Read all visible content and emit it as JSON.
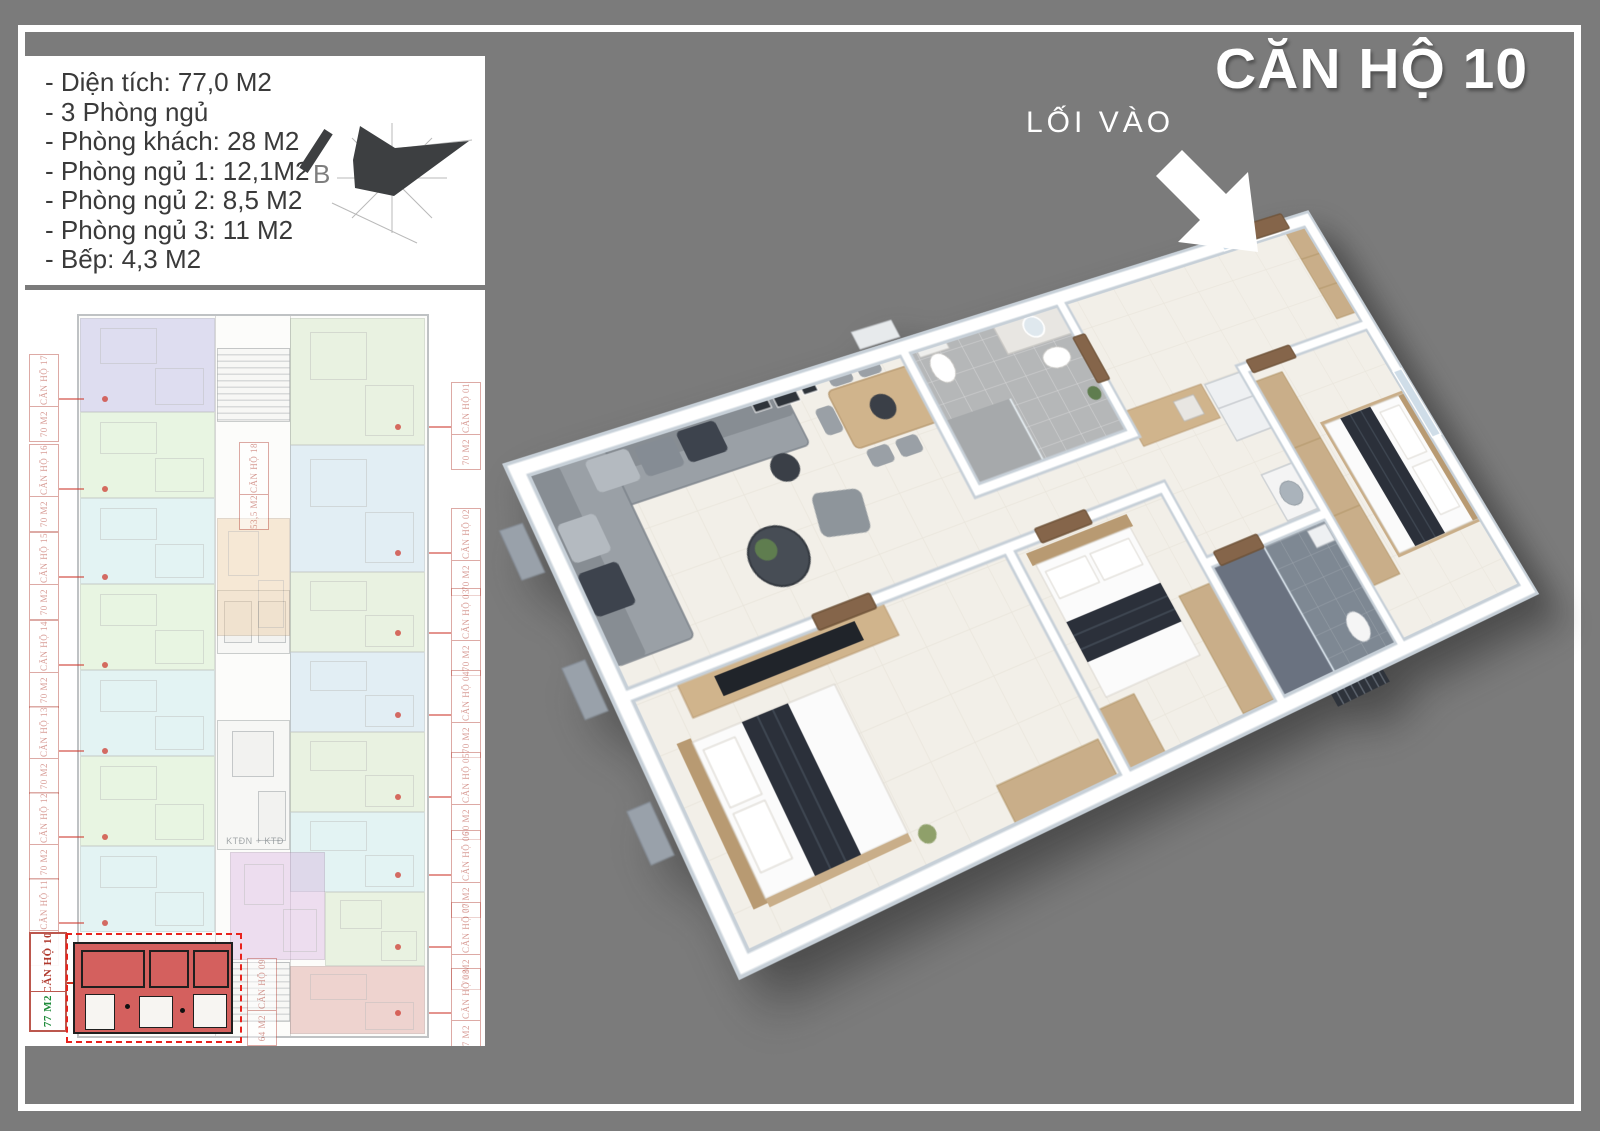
{
  "title": "CĂN HỘ 10",
  "entrance": {
    "label": "LỐI VÀO"
  },
  "compass": {
    "north_label": "B"
  },
  "info_panel": {
    "lines": [
      "- Diện tích: 77,0 M2",
      "- 3 Phòng ngủ",
      "- Phòng khách: 28 M2",
      "- Phòng ngủ 1: 12,1M2",
      "- Phòng ngủ 2: 8,5 M2",
      "- Phòng ngủ 3: 11 M2",
      "- Bếp: 4,3 M2"
    ]
  },
  "building_panel": {
    "elevator_room_label": "KTĐN + KTĐ",
    "highlighted_unit": "10",
    "units": [
      {
        "id": "17",
        "name": "CĂN HỘ 17",
        "area": "70 M2",
        "color": "#b7b4e3",
        "label_side": "left"
      },
      {
        "id": "16",
        "name": "CĂN HỘ 16",
        "area": "70 M2",
        "color": "#cdedc3",
        "label_side": "left"
      },
      {
        "id": "15",
        "name": "CĂN HỘ 15",
        "area": "70 M2",
        "color": "#c2e8ea",
        "label_side": "left"
      },
      {
        "id": "14",
        "name": "CĂN HỘ 14",
        "area": "70 M2",
        "color": "#cdedc3",
        "label_side": "left"
      },
      {
        "id": "13",
        "name": "CĂN HỘ 13",
        "area": "70 M2",
        "color": "#c2e8ea",
        "label_side": "left"
      },
      {
        "id": "12",
        "name": "CĂN HỘ 12",
        "area": "70 M2",
        "color": "#cdedc3",
        "label_side": "left"
      },
      {
        "id": "11",
        "name": "CĂN HỘ 11",
        "area": "70 M2",
        "color": "#c2e8ea",
        "label_side": "left"
      },
      {
        "id": "10",
        "name": "CĂN HỘ 10",
        "area": "77 M2",
        "color": "#d4605e",
        "label_side": "left",
        "highlight": true,
        "area_color": "#1e8b3a"
      },
      {
        "id": "01",
        "name": "CĂN HỘ 01",
        "area": "70 M2",
        "color": "#cfe6c0",
        "label_side": "right"
      },
      {
        "id": "02",
        "name": "CĂN HỘ 02",
        "area": "70 M2",
        "color": "#bfdcec",
        "label_side": "right"
      },
      {
        "id": "03",
        "name": "CĂN HỘ 03",
        "area": "70 M2",
        "color": "#cfe6c0",
        "label_side": "right"
      },
      {
        "id": "04",
        "name": "CĂN HỘ 04",
        "area": "70 M2",
        "color": "#bfdcec",
        "label_side": "right"
      },
      {
        "id": "05",
        "name": "CĂN HỘ 05",
        "area": "70 M2",
        "color": "#cfe6c0",
        "label_side": "right"
      },
      {
        "id": "06",
        "name": "CĂN HỘ 06",
        "area": "70 M2",
        "color": "#c2e8ea",
        "label_side": "right"
      },
      {
        "id": "07",
        "name": "CĂN HỘ 07",
        "area": "70 M2",
        "color": "#cfe6c0",
        "label_side": "right"
      },
      {
        "id": "08",
        "name": "CĂN HỘ 08",
        "area": "77 M2",
        "color": "#dc9b95",
        "label_side": "right"
      },
      {
        "id": "09",
        "name": "CĂN HỘ 09",
        "area": "64 M2",
        "color": "#d9b3e0",
        "label_side": "middle"
      },
      {
        "id": "18",
        "name": "CĂN HỘ 18",
        "area": "53,5 M2",
        "color": "#efcda4",
        "label_side": "middle"
      }
    ]
  },
  "colors": {
    "background": "#7b7b7b",
    "frame": "#ffffff",
    "highlight_fill": "#d4605e",
    "dashed_border": "#e8221c",
    "label_red": "#b03a2e",
    "label_green": "#1e8b3a",
    "wood": "#c9ae89",
    "navy_bedding": "#2b303a"
  }
}
